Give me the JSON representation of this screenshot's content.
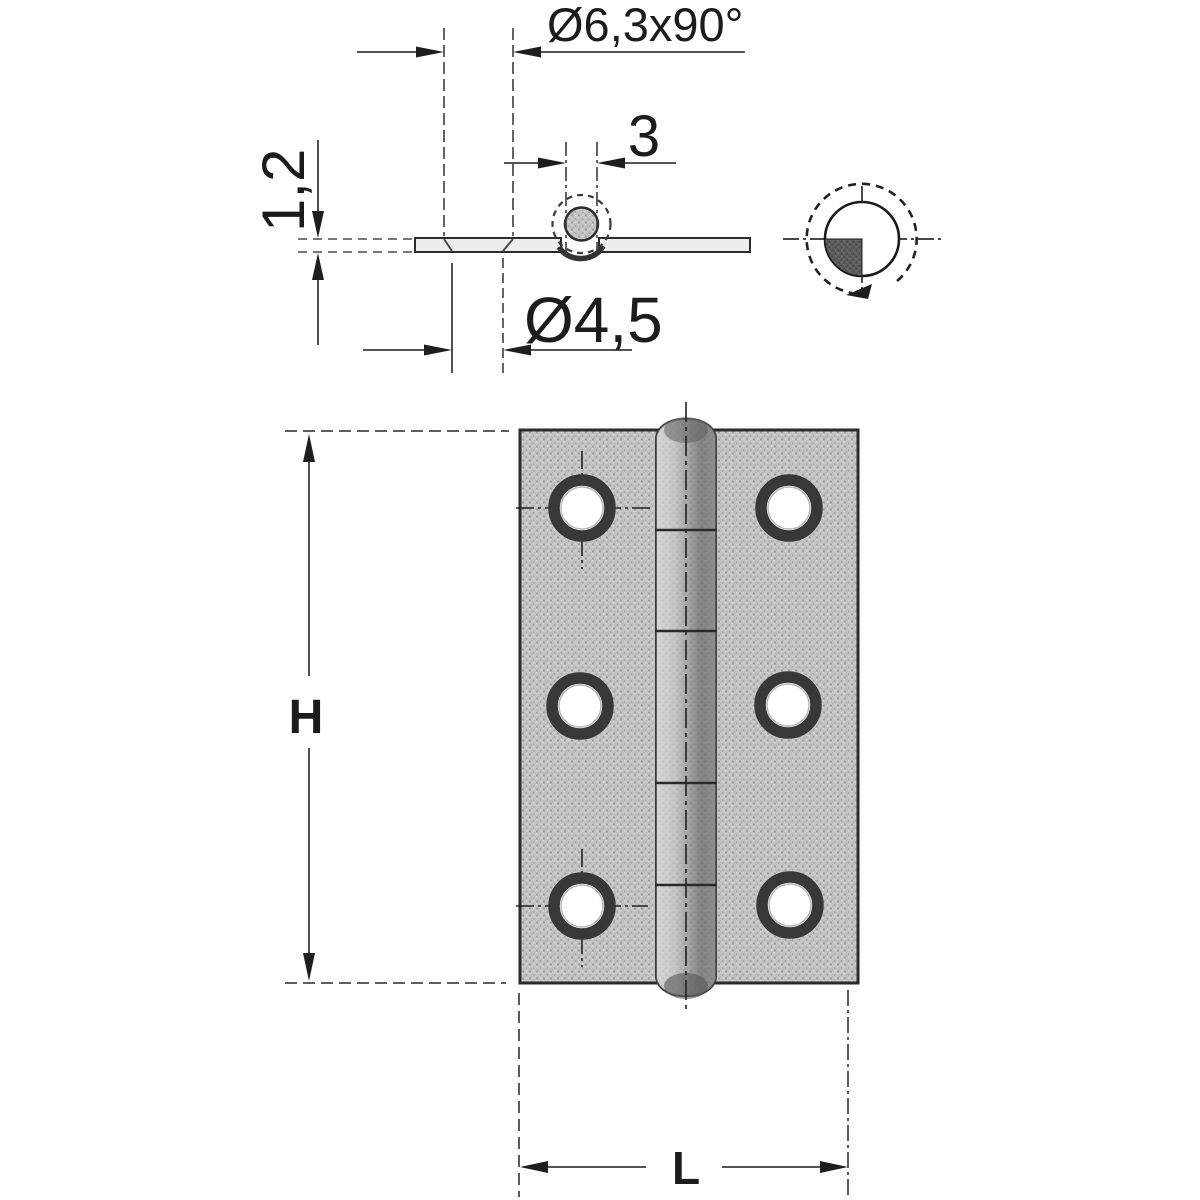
{
  "labels": {
    "countersink_dim": "Ø6,3x90°",
    "pin_diameter_dim": "3",
    "leaf_thickness_dim": "1,2",
    "hole_diameter_dim": "Ø4,5",
    "height_dim": "H",
    "length_dim": "L"
  },
  "front_view": {
    "hole_count": 6,
    "hole_rows": 3,
    "hole_columns": 2,
    "knuckle_segments": 5
  },
  "colors": {
    "line": "#2b2b2b",
    "plate_fill": "#c3c3c3",
    "pin_dark": "#6a6a6a",
    "detail_fill": "#5c5c5c",
    "background": "#ffffff"
  }
}
